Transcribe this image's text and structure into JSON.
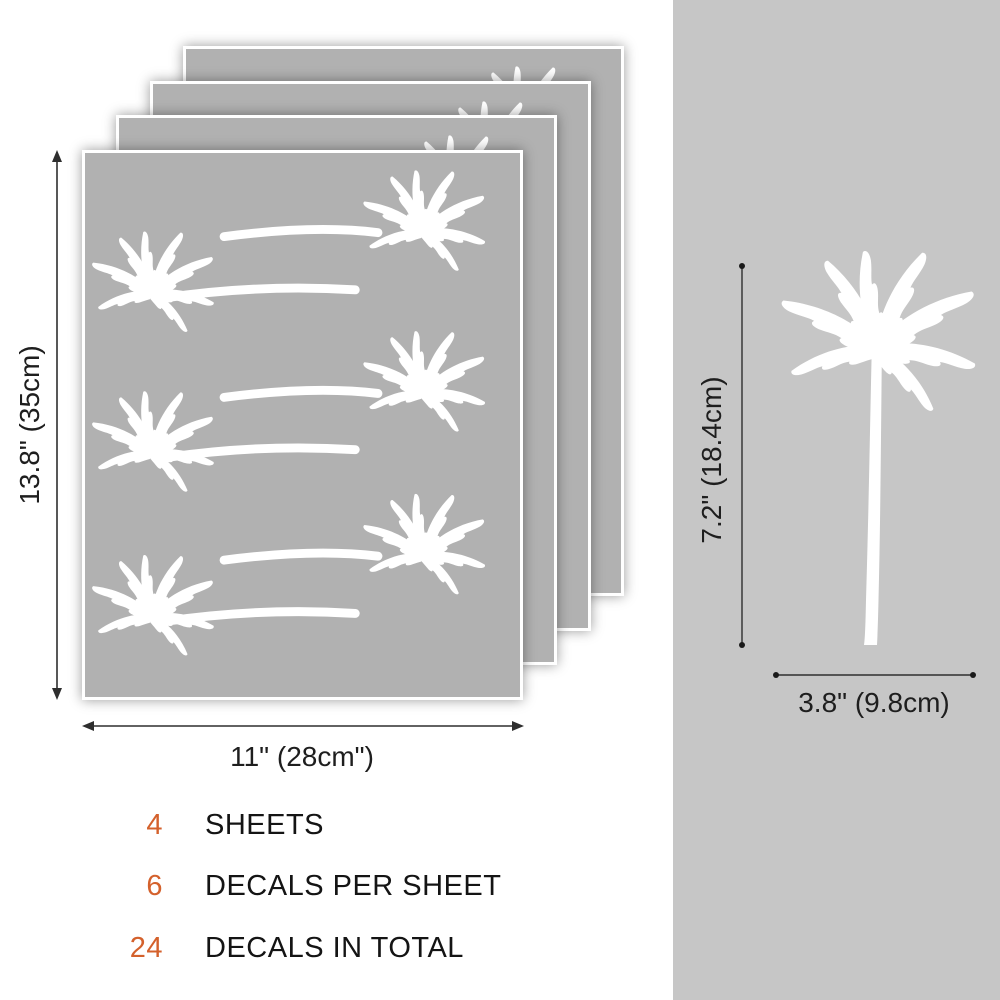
{
  "product": {
    "type": "palm-tree wall decal sheets",
    "sheet_stack": {
      "sheet_count": 4,
      "height_label": "13.8\" (35cm)",
      "width_label": "11\" (28cm\")",
      "decals_per_sheet": 6
    },
    "single_decal": {
      "height_label": "7.2\" (18.4cm)",
      "width_label": "3.8\" (9.8cm)"
    }
  },
  "summary": {
    "items": [
      {
        "number": "4",
        "label": "SHEETS"
      },
      {
        "number": "6",
        "label": "DECALS PER SHEET"
      },
      {
        "number": "24",
        "label": "DECALS IN TOTAL"
      }
    ]
  },
  "icons": {
    "sheet_decal": "palm-tree-with-horizontal-trunk",
    "single_decal": "palm-tree-icon"
  },
  "colors": {
    "accent_orange": "#d4612c",
    "sheet_gray": "#b1b1b1",
    "panel_gray": "#c6c6c6",
    "decal_white": "#ffffff",
    "dimension_line": "#2e2e2e",
    "background": "#ffffff"
  }
}
